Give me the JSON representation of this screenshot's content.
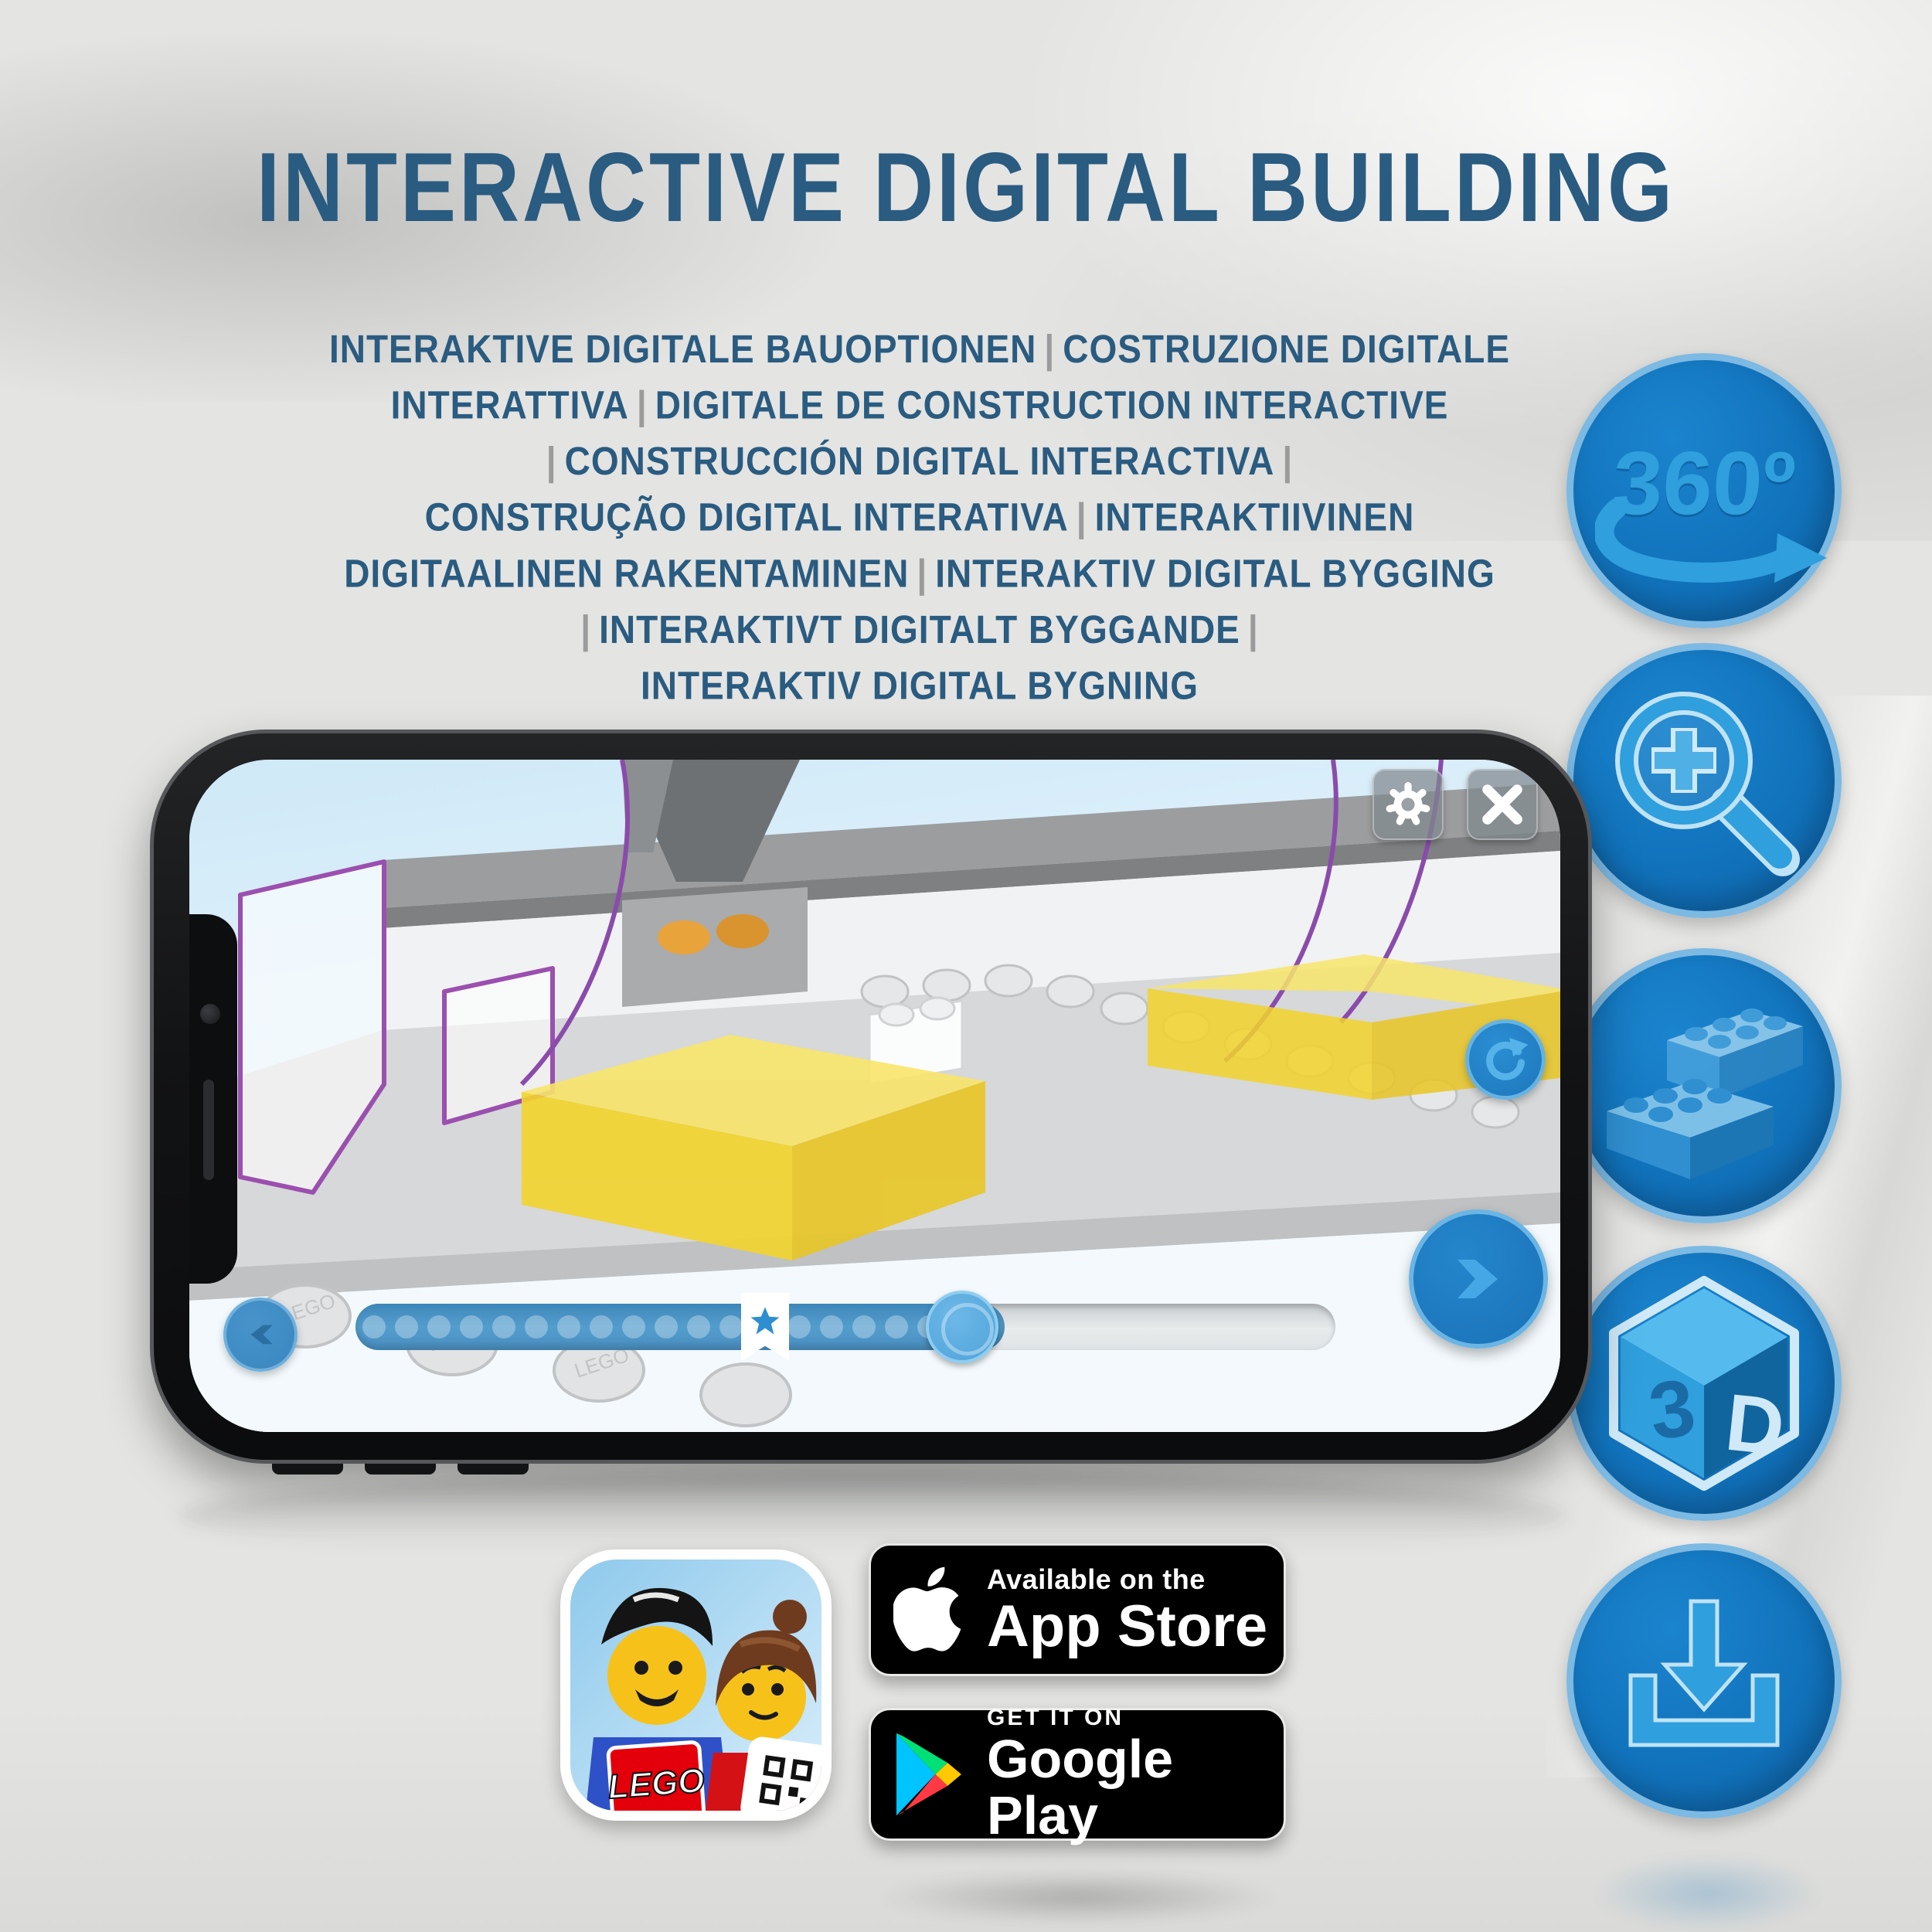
{
  "hero": {
    "title": "INTERACTIVE DIGITAL BUILDING"
  },
  "subtitle": {
    "lines": [
      "INTERAKTIVE DIGITALE BAUOPTIONEN | COSTRUZIONE DIGITALE",
      "INTERATTIVA | DIGITALE DE CONSTRUCTION INTERACTIVE",
      "| CONSTRUCCIÓN DIGITAL INTERACTIVA |",
      "CONSTRUÇÃO DIGITAL INTERATIVA | INTERAKTIIVINEN",
      "DIGITAALINEN RAKENTAMINEN | INTERAKTIV DIGITAL BYGGING",
      "| INTERAKTIVT DIGITALT BYGGANDE |",
      "INTERAKTIV DIGITAL BYGNING"
    ]
  },
  "feature_icons": {
    "rotation_label": "360º",
    "cube_left_letter": "3",
    "cube_right_letter": "D"
  },
  "phone": {
    "slider": {
      "dots_before_bookmark": 12,
      "dots_after_bookmark": 5
    }
  },
  "badges": {
    "app_store": {
      "line1": "Available on the",
      "line2": "App Store"
    },
    "google_play": {
      "line1": "GET IT ON",
      "line2": "Google Play"
    }
  },
  "app_icon": {
    "logo_text": "LEGO"
  },
  "colors": {
    "heading_blue": "#2a5b80",
    "separator_gray": "#9b9b9b",
    "icon_circle_blue": "#1173bc",
    "icon_glyph_blue": "#2f9fdd",
    "slider_fill_blue": "#4e97c9",
    "highlight_yellow": "#f3d42c",
    "ghost_outline_purple": "#9b4fae"
  }
}
